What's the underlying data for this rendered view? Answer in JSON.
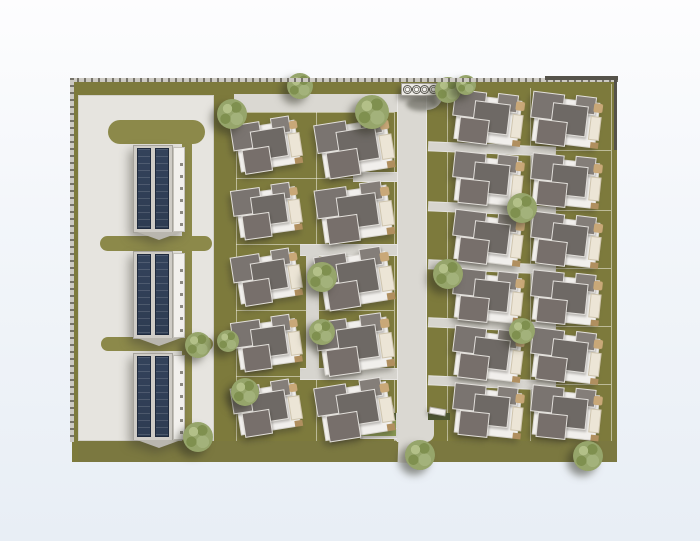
{
  "meta": {
    "title": "aerial-site-plan-render",
    "description": "Top-down 3D rendering of a residential development: 3 apartment blocks with rooftop solar panels on a paved court (left), 22 detached houses with dark grey roofs on olive-green lots (middle and right), internal roads, boundary fence, trees and entrance gate.",
    "width": 700,
    "height": 541
  },
  "palette": {
    "olive_base": "#7d7a3c",
    "olive_light": "#8c894a",
    "band": "#7b7840",
    "pave": "#e6e4df",
    "road": "#dad8d2",
    "lane": "#d7d5cf",
    "roof1": "#7a7470",
    "roof2": "#6e6965",
    "roof3": "#776f6b",
    "roof4": "#847e79",
    "wall": "#f1efec",
    "solar": "#2e3c52",
    "bldg": "#cfccc6",
    "tree_main": "#96a56b",
    "tree_dark": "#7f904f",
    "tan": "#c9a878",
    "dark_edge": "#55524a"
  },
  "scene": {
    "ground": [
      {
        "x": 72,
        "y": 82,
        "w": 545,
        "h": 380,
        "c": "olive_base",
        "name": "site-ground"
      },
      {
        "x": 78,
        "y": 95,
        "w": 136,
        "h": 346,
        "c": "pave",
        "cls": "pave",
        "name": "paved-courtyard"
      },
      {
        "x": 78,
        "y": 441,
        "w": 539,
        "h": 21,
        "c": "band",
        "name": "bottom-green-band"
      },
      {
        "x": 108,
        "y": 120,
        "w": 97,
        "h": 24,
        "c": "olive_light",
        "r": "12px",
        "name": "planting-strip"
      },
      {
        "x": 100,
        "y": 236,
        "w": 112,
        "h": 15,
        "c": "olive_light",
        "r": "8px",
        "name": "planting-strip"
      },
      {
        "x": 101,
        "y": 337,
        "w": 112,
        "h": 14,
        "c": "olive_light",
        "r": "8px",
        "name": "planting-strip"
      },
      {
        "x": 182,
        "y": 132,
        "w": 10,
        "h": 309,
        "c": "olive_light",
        "name": "planting-strip"
      }
    ],
    "lot_lines": [
      {
        "x": 236,
        "y": 112,
        "w": 1,
        "h": 329
      },
      {
        "x": 316,
        "y": 112,
        "w": 1,
        "h": 329
      },
      {
        "x": 394,
        "y": 112,
        "w": 1,
        "h": 329
      },
      {
        "x": 236,
        "y": 112,
        "w": 158,
        "h": 1
      },
      {
        "x": 236,
        "y": 178,
        "w": 158,
        "h": 1
      },
      {
        "x": 236,
        "y": 244,
        "w": 158,
        "h": 1
      },
      {
        "x": 236,
        "y": 310,
        "w": 158,
        "h": 1
      },
      {
        "x": 236,
        "y": 376,
        "w": 158,
        "h": 1
      },
      {
        "x": 447,
        "y": 88,
        "w": 1,
        "h": 353
      },
      {
        "x": 530,
        "y": 88,
        "w": 1,
        "h": 353
      },
      {
        "x": 611,
        "y": 84,
        "w": 1,
        "h": 357
      },
      {
        "x": 447,
        "y": 150,
        "w": 164,
        "h": 1
      },
      {
        "x": 447,
        "y": 210,
        "w": 164,
        "h": 1
      },
      {
        "x": 447,
        "y": 268,
        "w": 164,
        "h": 1
      },
      {
        "x": 447,
        "y": 326,
        "w": 164,
        "h": 1
      },
      {
        "x": 447,
        "y": 384,
        "w": 164,
        "h": 1
      }
    ],
    "roads": [
      {
        "x": 234,
        "y": 94,
        "w": 193,
        "h": 18,
        "c": "road",
        "name": "top-road"
      },
      {
        "x": 397,
        "y": 94,
        "w": 30,
        "h": 348,
        "c": "road",
        "cls": "edge",
        "name": "main-road"
      },
      {
        "x": 427,
        "y": 94,
        "w": 16,
        "h": 16,
        "c": "road",
        "r": "0 0 16px 0",
        "name": "road-corner"
      },
      {
        "x": 392,
        "y": 412,
        "w": 42,
        "h": 30,
        "c": "road",
        "r": "8px",
        "name": "entrance-plaza"
      },
      {
        "x": 398,
        "y": 438,
        "w": 28,
        "h": 25,
        "c": "road",
        "rot": 2,
        "name": "entrance-road"
      },
      {
        "x": 300,
        "y": 244,
        "w": 97,
        "h": 12,
        "cls": "lane",
        "name": "driveway"
      },
      {
        "x": 300,
        "y": 368,
        "w": 97,
        "h": 12,
        "cls": "lane",
        "name": "driveway"
      },
      {
        "x": 306,
        "y": 244,
        "w": 13,
        "h": 136,
        "cls": "lane",
        "name": "driveway"
      },
      {
        "x": 353,
        "y": 172,
        "w": 44,
        "h": 10,
        "cls": "lane",
        "name": "driveway"
      },
      {
        "x": 360,
        "y": 428,
        "w": 37,
        "h": 11,
        "cls": "lane",
        "name": "driveway"
      },
      {
        "x": 428,
        "y": 144,
        "w": 128,
        "h": 10,
        "cls": "lane",
        "rot": 2.5,
        "name": "driveway"
      },
      {
        "x": 428,
        "y": 204,
        "w": 128,
        "h": 10,
        "cls": "lane",
        "rot": 2.5,
        "name": "driveway"
      },
      {
        "x": 428,
        "y": 262,
        "w": 128,
        "h": 10,
        "cls": "lane",
        "rot": 2.5,
        "name": "driveway"
      },
      {
        "x": 428,
        "y": 320,
        "w": 128,
        "h": 10,
        "cls": "lane",
        "rot": 2.5,
        "name": "driveway"
      },
      {
        "x": 428,
        "y": 378,
        "w": 128,
        "h": 10,
        "cls": "lane",
        "rot": 2.5,
        "name": "driveway"
      },
      {
        "x": 531,
        "y": 154,
        "w": 10,
        "h": 18,
        "cls": "lane",
        "name": "driveway"
      },
      {
        "x": 531,
        "y": 214,
        "w": 10,
        "h": 18,
        "cls": "lane",
        "name": "driveway"
      },
      {
        "x": 531,
        "y": 272,
        "w": 10,
        "h": 18,
        "cls": "lane",
        "name": "driveway"
      },
      {
        "x": 531,
        "y": 330,
        "w": 10,
        "h": 18,
        "cls": "lane",
        "name": "driveway"
      },
      {
        "x": 531,
        "y": 388,
        "w": 10,
        "h": 18,
        "cls": "lane",
        "name": "driveway"
      }
    ],
    "deco": [
      {
        "x": 358,
        "y": 418,
        "w": 38,
        "h": 18,
        "c": "#8b9a52",
        "name": "grass-patch"
      },
      {
        "x": 354,
        "y": 413,
        "w": 42,
        "h": 7,
        "c": "#4e5731",
        "name": "hedge"
      },
      {
        "x": 428,
        "y": 413,
        "w": 22,
        "h": 7,
        "c": "#4e5731",
        "name": "hedge"
      },
      {
        "x": 406,
        "y": 97,
        "w": 32,
        "h": 14,
        "c": "rgba(48,48,38,0.45)",
        "r": "50%",
        "cls": "soft",
        "name": "shadow-blob"
      },
      {
        "x": 377,
        "y": 407,
        "w": 17,
        "h": 7,
        "c": "wall",
        "rot": -14,
        "cls": "gwall",
        "name": "gate-wall-left"
      },
      {
        "x": 429,
        "y": 408,
        "w": 17,
        "h": 7,
        "c": "wall",
        "rot": 10,
        "cls": "gwall",
        "name": "gate-wall-right"
      }
    ],
    "buildings": [
      {
        "x": 133,
        "y": 145
      },
      {
        "x": 133,
        "y": 251
      },
      {
        "x": 133,
        "y": 353
      }
    ],
    "houses": [
      {
        "x": 268,
        "y": 145,
        "rot": -9,
        "t": "a"
      },
      {
        "x": 268,
        "y": 211,
        "rot": -8,
        "t": "a"
      },
      {
        "x": 268,
        "y": 277,
        "rot": -9,
        "t": "a"
      },
      {
        "x": 268,
        "y": 343,
        "rot": -8,
        "t": "a"
      },
      {
        "x": 268,
        "y": 408,
        "rot": -9,
        "t": "a"
      },
      {
        "x": 356,
        "y": 147,
        "rot": -9,
        "t": "b"
      },
      {
        "x": 356,
        "y": 213,
        "rot": -8,
        "t": "b"
      },
      {
        "x": 356,
        "y": 279,
        "rot": -9,
        "t": "b"
      },
      {
        "x": 356,
        "y": 345,
        "rot": -8,
        "t": "b"
      },
      {
        "x": 356,
        "y": 410,
        "rot": -9,
        "t": "b"
      },
      {
        "x": 489,
        "y": 119,
        "rot": 7,
        "t": "c"
      },
      {
        "x": 489,
        "y": 180,
        "rot": 6,
        "t": "c"
      },
      {
        "x": 489,
        "y": 239,
        "rot": 7,
        "t": "c"
      },
      {
        "x": 489,
        "y": 297,
        "rot": 6,
        "t": "c"
      },
      {
        "x": 489,
        "y": 355,
        "rot": 7,
        "t": "c"
      },
      {
        "x": 489,
        "y": 412,
        "rot": 6,
        "t": "c"
      },
      {
        "x": 567,
        "y": 121,
        "rot": 7,
        "t": "d"
      },
      {
        "x": 567,
        "y": 182,
        "rot": 6,
        "t": "d"
      },
      {
        "x": 567,
        "y": 241,
        "rot": 7,
        "t": "d"
      },
      {
        "x": 567,
        "y": 299,
        "rot": 6,
        "t": "d"
      },
      {
        "x": 567,
        "y": 357,
        "rot": 7,
        "t": "d"
      },
      {
        "x": 567,
        "y": 414,
        "rot": 6,
        "t": "d"
      }
    ],
    "tanks": {
      "x": 401,
      "y": 82,
      "count": 4
    },
    "trees": [
      {
        "x": 300,
        "y": 86,
        "d": 26
      },
      {
        "x": 372,
        "y": 112,
        "d": 34
      },
      {
        "x": 448,
        "y": 90,
        "d": 26
      },
      {
        "x": 466,
        "y": 85,
        "d": 20
      },
      {
        "x": 232,
        "y": 114,
        "d": 30
      },
      {
        "x": 322,
        "y": 277,
        "d": 30
      },
      {
        "x": 322,
        "y": 332,
        "d": 26
      },
      {
        "x": 245,
        "y": 392,
        "d": 28
      },
      {
        "x": 198,
        "y": 345,
        "d": 26
      },
      {
        "x": 228,
        "y": 341,
        "d": 22
      },
      {
        "x": 198,
        "y": 437,
        "d": 30
      },
      {
        "x": 522,
        "y": 208,
        "d": 30
      },
      {
        "x": 448,
        "y": 274,
        "d": 30
      },
      {
        "x": 522,
        "y": 331,
        "d": 26
      },
      {
        "x": 420,
        "y": 455,
        "d": 30
      },
      {
        "x": 588,
        "y": 456,
        "d": 30
      }
    ],
    "fence": [
      {
        "x": 70,
        "y": 78,
        "w": 548,
        "h": 4,
        "cls": "fence-h",
        "name": "boundary-fence-top"
      },
      {
        "x": 70,
        "y": 78,
        "w": 4,
        "h": 364,
        "cls": "fence-v",
        "name": "boundary-fence-left"
      },
      {
        "x": 545,
        "y": 76,
        "w": 73,
        "h": 4,
        "c": "dark_edge",
        "name": "boundary-wall-top-right"
      },
      {
        "x": 614,
        "y": 80,
        "w": 3,
        "h": 70,
        "c": "dark_edge",
        "name": "boundary-wall-right"
      }
    ]
  }
}
